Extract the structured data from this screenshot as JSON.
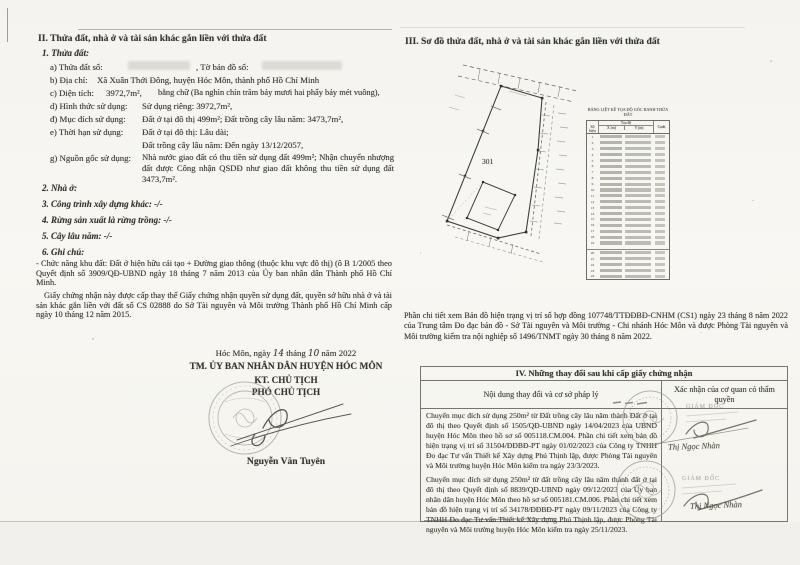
{
  "page_left": {
    "section_title": "II. Thửa đất, nhà ở và tài sản khác gắn liền với thửa đất",
    "sub1": "1. Thửa đất:",
    "a_label": "a) Thửa đất số:",
    "a_label2": ", Tờ bản đồ số:",
    "b_label": "b) Địa chỉ:",
    "b_value": "Xã Xuân Thới Đông, huyện Hóc Môn, thành phố Hồ Chí Minh",
    "c_label": "c) Diện tích:",
    "c_value": "3972,7m²,",
    "c_words": "bằng chữ (Ba nghìn chín trăm bảy mươi hai phẩy bảy mét vuông),",
    "d_label": "d) Hình thức sử dụng:",
    "d_value": "Sử dụng riêng: 3972,7m²,",
    "dd_label": "đ) Mục đích sử dụng:",
    "dd_value": "Đất ở tại đô thị 499m²; Đất trồng cây lâu năm: 3473,7m²,",
    "e_label": "e) Thời hạn sử dụng:",
    "e_value1": "Đất ở tại đô thị: Lâu dài;",
    "e_value2": "Đất trồng cây lâu năm: Đến ngày 13/12/2057,",
    "g_label": "g) Nguồn gốc sử dụng:",
    "g_value": "Nhà nước giao đất có thu tiền sử dụng đất 499m²; Nhận chuyển nhượng đất được Công nhận QSDĐ như giao đất không thu tiền sử dụng đất 3473,7m².",
    "sub2": "2. Nhà ở:",
    "sub3": "3. Công trình xây dựng khác: -/-",
    "sub4": "4. Rừng sản xuất là rừng trồng: -/-",
    "sub5": "5. Cây lâu năm: -/-",
    "sub6": "6. Ghi chú:",
    "note1": "- Chức năng khu đất: Đất ở hiện hữu cải tạo + Đường giao thông (thuộc khu vực đô thị) (ô B 1/2005 theo Quyết định số 3909/QĐ-UBND ngày 18 tháng 7 năm 2013 của Ủy ban nhân dân Thành phố Hồ Chí Minh.",
    "note2": "Giấy chứng nhận này được cấp thay thế Giấy chứng nhận quyền sử dụng đất, quyền sở hữu nhà ở và tài sản khác gắn liền với đất số CS 02888 do Sở Tài nguyên và Môi trường Thành phố Hồ Chí Minh cấp ngày 10 tháng 12 năm 2015.",
    "date_prefix": "Hóc Môn, ngày",
    "date_day": "14",
    "date_mid": "tháng",
    "date_month": "10",
    "date_suffix": "năm 2022",
    "issuer_line1": "TM. ỦY BAN NHÂN DÂN HUYỆN HÓC MÔN",
    "issuer_line2": "KT. CHỦ TỊCH",
    "issuer_line3": "PHÓ CHỦ TỊCH",
    "signer_name": "Nguyễn Văn Tuyên"
  },
  "page_right": {
    "section_title": "III. Sơ đồ thửa đất, nhà ở và tài sản khác gắn liền với thửa đất",
    "map": {
      "parcel_number": "301"
    },
    "coord_table": {
      "caption": "BẢNG LIỆT KÊ TỌA ĐỘ GÓC RANH THỬA ĐẤT",
      "col_point": "Số hiệu",
      "col_xy": "Tọa độ",
      "col_x": "X (m)",
      "col_y": "Y (m)",
      "col_edge": "Cạnh",
      "row_count": 24
    },
    "note": "Phần chi tiết xem Bản đồ hiện trạng vị trí số hợp đồng 107748/TTĐĐBĐ-CNHM (CS1) ngày 23 tháng 8 năm 2022 của Trung tâm Đo đạc bản đồ - Sở Tài nguyên và Môi trường - Chi nhánh Hóc Môn và được Phòng Tài nguyên và Môi trường kiểm tra nội nghiệp số 1496/TNMT ngày 30 tháng 8 năm 2022.",
    "section4": {
      "title": "IV. Những thay đổi sau khi cấp giấy chứng nhận",
      "col1": "Nội dung thay đổi và cơ sở pháp lý",
      "col2": "Xác nhận của cơ quan có thẩm quyền",
      "entries": [
        {
          "text": "Chuyển mục đích sử dụng 250m² từ Đất trồng cây lâu năm thành Đất ở tại đô thị theo Quyết định số 1505/QĐ-UBND ngày 14/04/2023 của UBND huyện Hóc Môn theo hồ sơ số 005118.CM.004. Phần chi tiết xem bản đồ hiện trạng vị trí số 31504/ĐĐBĐ-PT ngày 01/02/2023 của Công ty TNHH Đo đạc Tư vấn Thiết kế Xây dựng Phú Thịnh lập, được Phòng Tài nguyên và Môi trường huyện Hóc Môn kiểm tra ngày 23/3/2023."
        },
        {
          "text": "Chuyển mục đích sử dụng 250m² từ đất trồng cây lâu năm thành đất ở tại đô thị theo Quyết định số 8839/QĐ-UBND ngày 09/12/2023 của Ủy ban nhân dân huyện Hóc Môn theo hồ sơ số 005181.CM.006. Phần chi tiết xem bản đồ hiện trạng vị trí số 34178/ĐĐBĐ-PT ngày 09/11/2023 của Công ty TNHH Đo đạc Tư vấn Thiết kế Xây dựng Phú Thịnh lập, được Phòng Tài nguyên và Môi trường huyện Hóc Môn kiểm tra ngày 25/11/2023."
        }
      ],
      "stamp1_office": "GIÁM ĐỐC",
      "stamp2_office": "GIÁM ĐỐC",
      "stamp1_signer": "Thị Ngọc Nhàn",
      "stamp2_signer": "Thị Ngọc Nhàn"
    }
  }
}
